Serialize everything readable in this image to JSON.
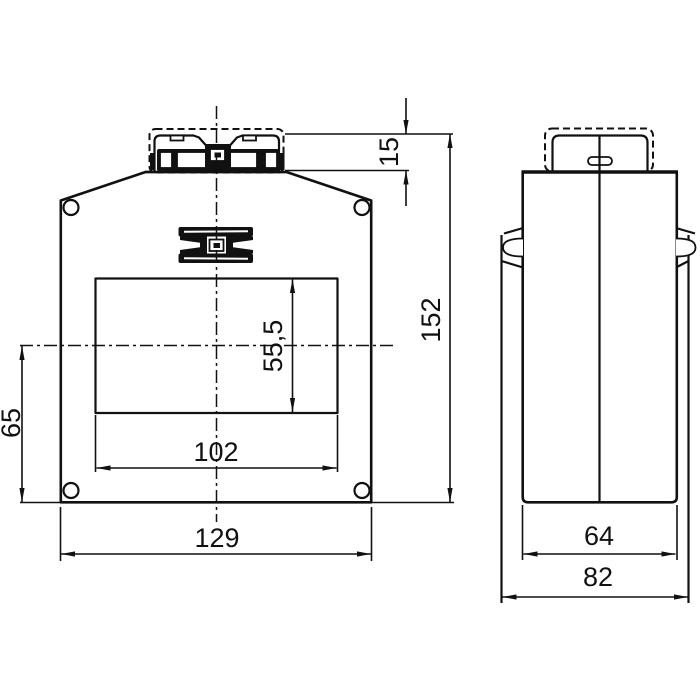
{
  "colors": {
    "background": "#ffffff",
    "line": "#111111"
  },
  "front_view": {
    "dims": {
      "terminal_height": "15",
      "total_height": "152",
      "window_height": "55,5",
      "axis_to_bottom": "65",
      "window_width": "102",
      "overall_width": "129"
    }
  },
  "side_view": {
    "dims": {
      "body_width": "64",
      "overall_width": "82"
    }
  }
}
